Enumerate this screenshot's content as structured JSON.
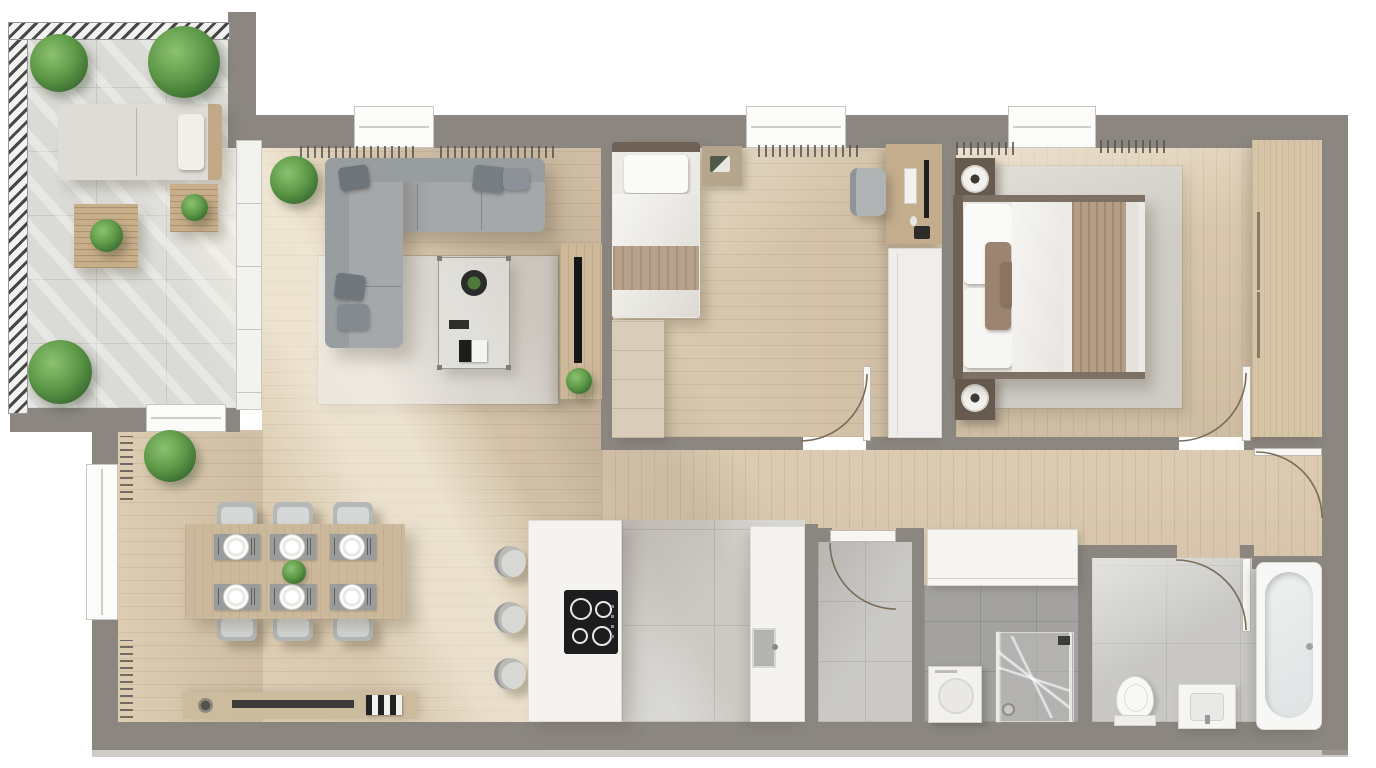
{
  "document_type": "apartment-floor-plan-render",
  "view": "top-down-3d",
  "visible_text": [],
  "palette": {
    "wall": "#8b8680",
    "wall-light": "#a9a49d",
    "wood": "#d9c7aa",
    "tile-terrace": "#dadad6",
    "rug": "#d9d5cf",
    "sofa": "#a4a8ab",
    "white-fixture": "#f6f5f2",
    "wood-furniture": "#c9ae8a",
    "wardrobe-wood": "#d5c4a6",
    "dark-nightstand": "#675a4e",
    "plant": "#5f9a48",
    "cooktop": "#1d1d1f",
    "blanket": "#b49e86",
    "arc-stroke": "#7a6c5a"
  },
  "rooms": [
    {
      "id": "terrace",
      "furniture": [
        "railing",
        "lounge-sofa",
        "coffee-table-large",
        "coffee-table-small",
        "plants"
      ],
      "plant_count": 5
    },
    {
      "id": "living-room",
      "furniture": [
        "corner-sofa",
        "glass-coffee-table",
        "rug",
        "tv-console",
        "tv",
        "plant",
        "radiators"
      ],
      "radiator_count": 2
    },
    {
      "id": "dining-area",
      "furniture": [
        "dining-table",
        "dining-chairs",
        "place-settings",
        "centerpiece-plant",
        "sideboard",
        "corner-plant",
        "wall-radiators"
      ],
      "chair_count": 6,
      "place_setting_count": 6
    },
    {
      "id": "kitchen",
      "furniture": [
        "island-with-cooktop",
        "bar-stools",
        "counter-with-sink"
      ],
      "stool_count": 3,
      "burner_count": 4
    },
    {
      "id": "bedroom-1",
      "furniture": [
        "single-bed",
        "nightstand",
        "dresser",
        "desk",
        "desk-chair",
        "wardrobe",
        "door"
      ]
    },
    {
      "id": "master-bedroom",
      "furniture": [
        "double-bed",
        "nightstands",
        "table-lamps",
        "rug",
        "wardrobe",
        "radiators",
        "door"
      ],
      "nightstand_count": 2
    },
    {
      "id": "hallway",
      "furniture": [
        "built-in-cabinet",
        "door-to-hall"
      ]
    },
    {
      "id": "storage-room",
      "furniture": [
        "door"
      ]
    },
    {
      "id": "shower-room",
      "furniture": [
        "washing-machine",
        "walk-in-shower"
      ]
    },
    {
      "id": "bathroom",
      "furniture": [
        "toilet",
        "vanity-sink",
        "bathtub",
        "door"
      ]
    }
  ],
  "window_count": 5,
  "door_swing_count": 5
}
